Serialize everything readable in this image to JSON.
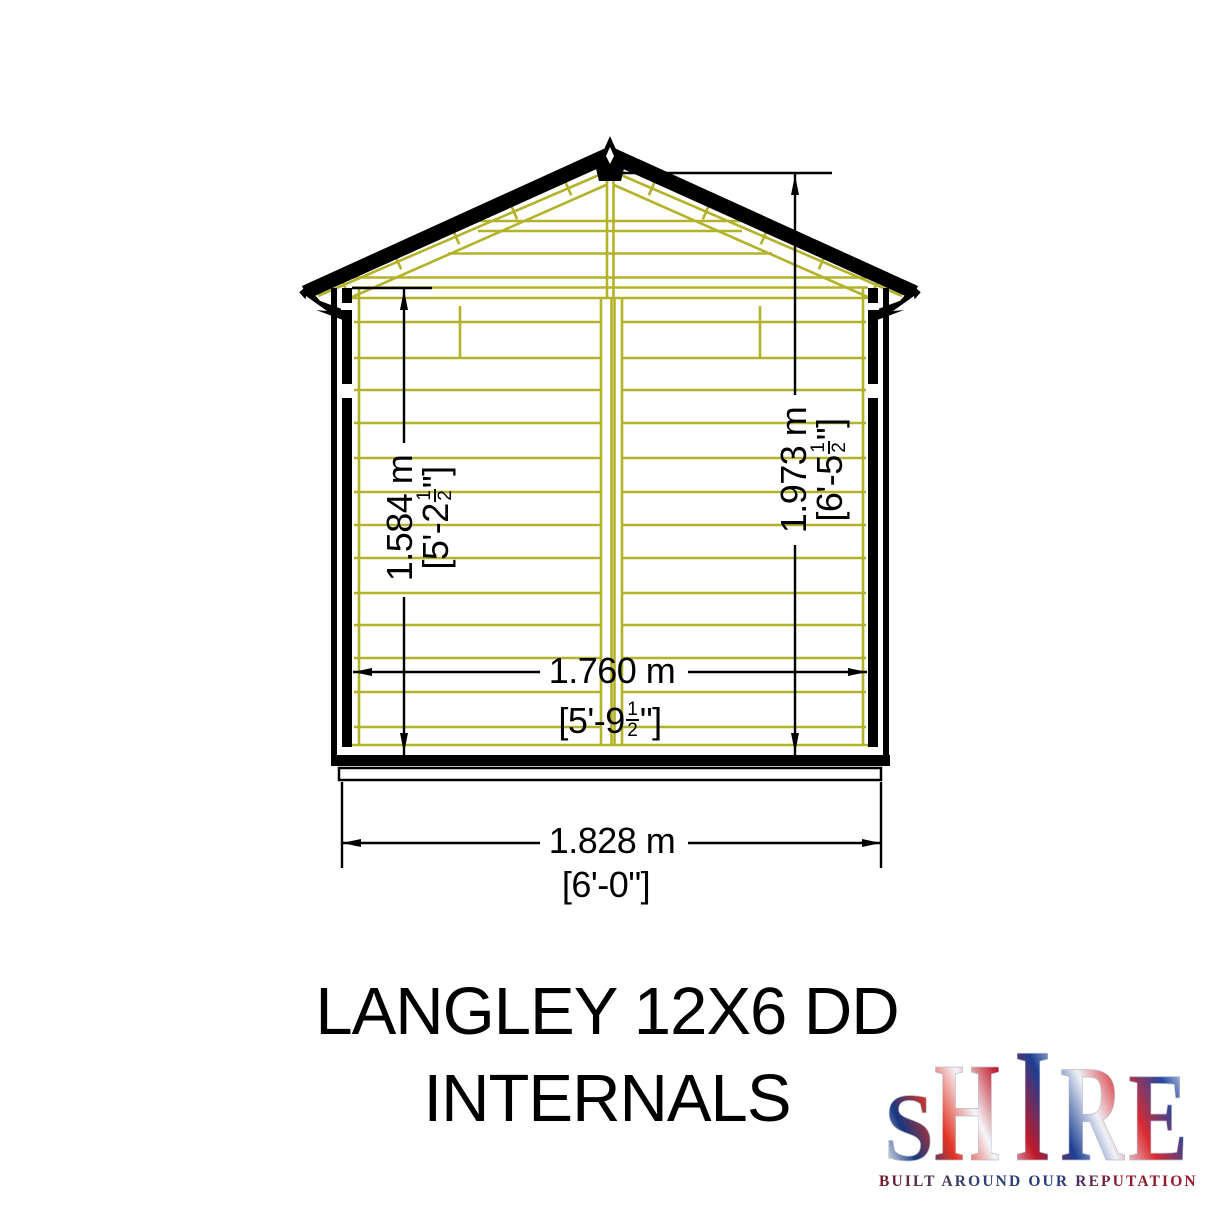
{
  "page": {
    "background": "#ffffff"
  },
  "drawing": {
    "title_line1": "LANGLEY 12X6 DD",
    "title_line2": "INTERNALS",
    "colors": {
      "timber": "#b3b32b",
      "ink": "#000000"
    },
    "dimensions": {
      "wall_height": {
        "metric": "1.584 m",
        "imp_prefix": "[5'-2",
        "frac_num": "1",
        "frac_den": "2",
        "imp_suffix": "\"]"
      },
      "ridge_height": {
        "metric": "1.973 m",
        "imp_prefix": "[6'-5",
        "frac_num": "1",
        "frac_den": "2",
        "imp_suffix": "\"]"
      },
      "internal_width": {
        "metric": "1.760 m",
        "imp_prefix": "[5'-9",
        "frac_num": "1",
        "frac_den": "2",
        "imp_suffix": "\"]"
      },
      "external_width": {
        "metric": "1.828 m",
        "imperial": "[6'-0\"]"
      }
    }
  },
  "logo": {
    "brand": "SHIRE",
    "brand_letters": [
      "S",
      "H",
      "I",
      "R",
      "E"
    ],
    "tagline": "BUILT AROUND OUR REPUTATION"
  }
}
